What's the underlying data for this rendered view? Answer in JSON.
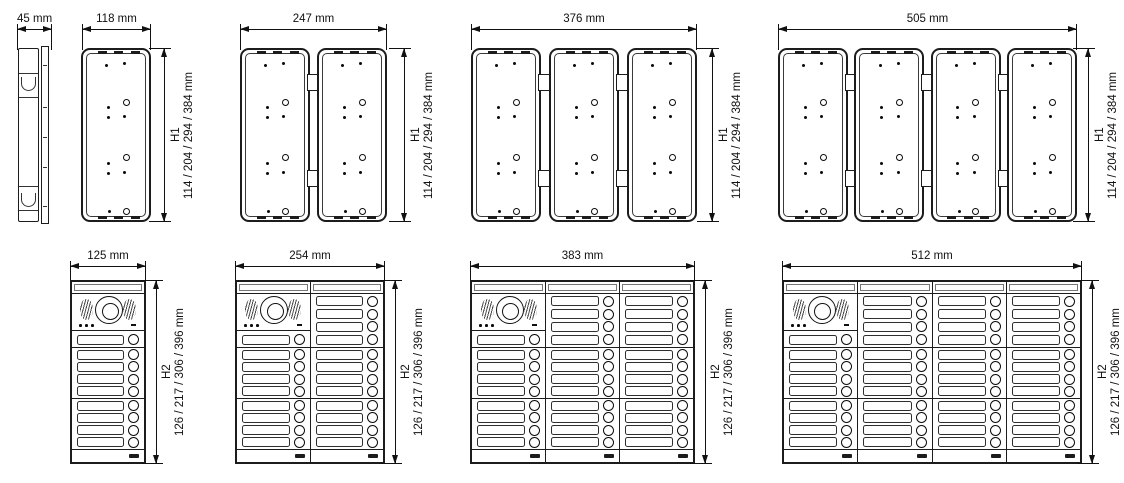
{
  "colors": {
    "line": "#1c1c1c",
    "background": "#ffffff"
  },
  "top_row": {
    "side_view": {
      "width_label": "45 mm"
    },
    "groups": [
      {
        "width_label": "118 mm",
        "boxes": 1,
        "height_label": "H1",
        "height_values": "114 / 204 / 294 / 384 mm"
      },
      {
        "width_label": "247 mm",
        "boxes": 2,
        "height_label": "H1",
        "height_values": "114 / 204 / 294 / 384 mm"
      },
      {
        "width_label": "376 mm",
        "boxes": 3,
        "height_label": "H1",
        "height_values": "114 / 204 / 294 / 384 mm"
      },
      {
        "width_label": "505 mm",
        "boxes": 4,
        "height_label": "H1",
        "height_values": "114 / 204 / 294 / 384 mm"
      }
    ]
  },
  "bottom_row": {
    "panels": [
      {
        "width_label": "125 mm",
        "columns": 1,
        "height_label": "H2",
        "height_values": "126 / 217 / 306 / 396 mm"
      },
      {
        "width_label": "254 mm",
        "columns": 2,
        "height_label": "H2",
        "height_values": "126 / 217 / 306 / 396 mm"
      },
      {
        "width_label": "383 mm",
        "columns": 3,
        "height_label": "H2",
        "height_values": "126 / 217 / 306 / 396 mm"
      },
      {
        "width_label": "512 mm",
        "columns": 4,
        "height_label": "H2",
        "height_values": "126 / 217 / 306 / 396 mm"
      }
    ],
    "button_rows_per_section": 4,
    "camera_column_led_count": 3
  }
}
